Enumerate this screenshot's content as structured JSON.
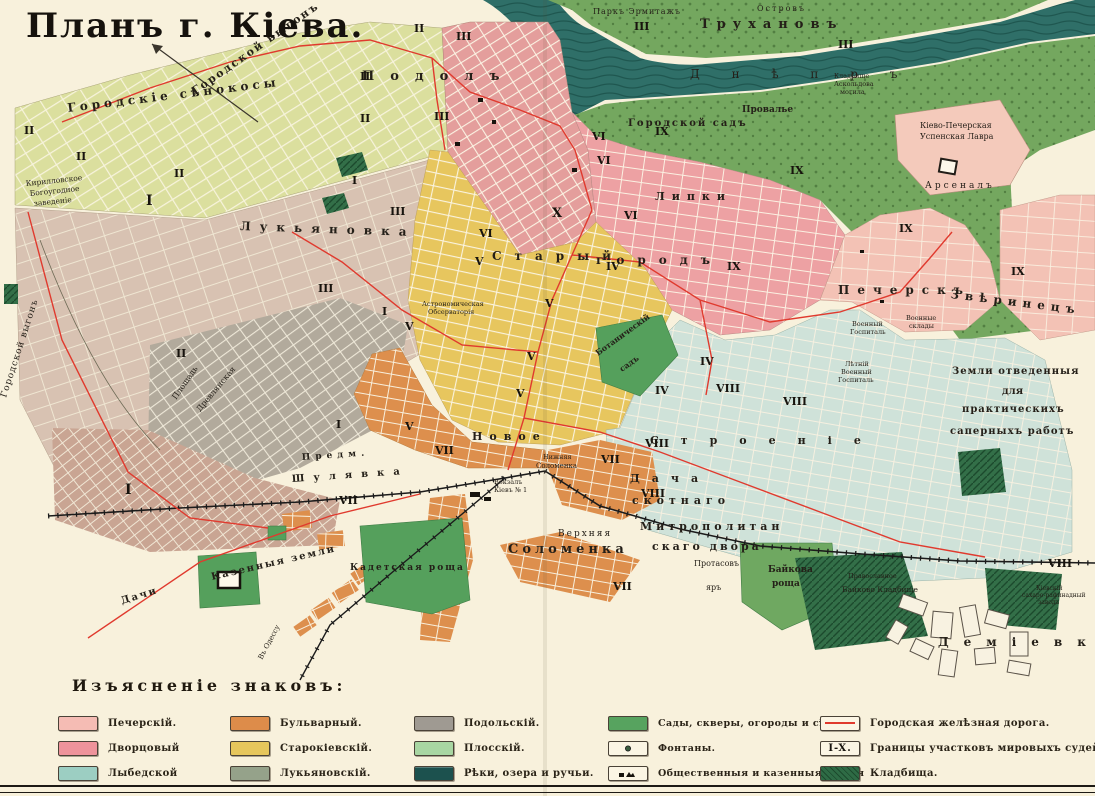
{
  "title": "Планъ г. Кіева.",
  "legend": {
    "heading": "Изъясненіе знаковъ:",
    "columns": [
      {
        "items": [
          {
            "label": "Печерскій.",
            "color": "#f5bcb4"
          },
          {
            "label": "Дворцовый",
            "color": "#ee939b"
          },
          {
            "label": "Лыбедской",
            "color": "#9ccec2"
          }
        ]
      },
      {
        "items": [
          {
            "label": "Бульварный.",
            "color": "#dd8c4a"
          },
          {
            "label": "Старокіевскій.",
            "color": "#e6c65c"
          },
          {
            "label": "Лукьяновскій.",
            "color": "#95a28a"
          }
        ]
      },
      {
        "items": [
          {
            "label": "Подольскій.",
            "color": "#9f9a92"
          },
          {
            "label": "Плосскій.",
            "color": "#a8d6a2"
          },
          {
            "label": "Рѣки, озера и ручьи.",
            "color": "#1c514e"
          }
        ]
      },
      {
        "items": [
          {
            "label": "Сады, скверы, огороды и сѣнок.",
            "color": "#57a35f"
          },
          {
            "label": "Фонтаны.",
            "type": "fountain"
          },
          {
            "label": "Общественныя и казенныя зданія",
            "type": "buildings"
          }
        ]
      },
      {
        "items": [
          {
            "label": "Городская желѣзная дорога.",
            "type": "railline",
            "color": "#e03a2e"
          },
          {
            "label": "Границы участковъ мировыхъ судей.",
            "type": "districts",
            "badge": "I-X."
          },
          {
            "label": "Кладбища.",
            "type": "cemetery",
            "color": "#2e6b45"
          }
        ]
      }
    ]
  },
  "map": {
    "river_name": "Днѣпръ",
    "labels": [
      {
        "text": "Городской выгонъ",
        "x": 195,
        "y": 95,
        "size": 11,
        "rot": -35,
        "ls": 2,
        "b": 1
      },
      {
        "text": "Городскіе сѣнокосы",
        "x": 68,
        "y": 112,
        "size": 12,
        "rot": -7,
        "ls": 4,
        "b": 1
      },
      {
        "text": "Городской выгонъ",
        "x": 6,
        "y": 398,
        "size": 9,
        "rot": -72,
        "ls": 1
      },
      {
        "text": "Кирилловское",
        "x": 26,
        "y": 186,
        "size": 7.5,
        "rot": -6
      },
      {
        "text": "Богоугодное",
        "x": 30,
        "y": 196,
        "size": 7.5,
        "rot": -6
      },
      {
        "text": "заведеніе",
        "x": 34,
        "y": 206,
        "size": 7.5,
        "rot": -6
      },
      {
        "text": "Паркъ Эрмитажъ",
        "x": 593,
        "y": 14,
        "size": 8,
        "ls": 1
      },
      {
        "text": "Островъ",
        "x": 757,
        "y": 11,
        "size": 8,
        "ls": 2
      },
      {
        "text": "Трухановъ",
        "x": 700,
        "y": 28,
        "size": 13,
        "ls": 7,
        "b": 1
      },
      {
        "text": "Д н ѣ п р ъ",
        "x": 690,
        "y": 78,
        "size": 12,
        "ls": 14,
        "c": "#143e3b"
      },
      {
        "text": "Подолъ",
        "x": 362,
        "y": 80,
        "size": 13,
        "ls": 16,
        "b": 1
      },
      {
        "text": "Провалье",
        "x": 742,
        "y": 112,
        "size": 9,
        "b": 1
      },
      {
        "text": "Городской садъ",
        "x": 628,
        "y": 126,
        "size": 10,
        "ls": 2,
        "b": 1
      },
      {
        "text": "Кладбище",
        "x": 834,
        "y": 78,
        "size": 6.5
      },
      {
        "text": "Аскольдова",
        "x": 834,
        "y": 86,
        "size": 6.5
      },
      {
        "text": "могила",
        "x": 840,
        "y": 94,
        "size": 6.5
      },
      {
        "text": "Кіево-Печерская",
        "x": 920,
        "y": 128,
        "size": 8
      },
      {
        "text": "Успенская Лавра",
        "x": 920,
        "y": 139,
        "size": 8
      },
      {
        "text": "Арсеналъ",
        "x": 925,
        "y": 188,
        "size": 9,
        "ls": 3
      },
      {
        "text": "Липки",
        "x": 655,
        "y": 200,
        "size": 11,
        "ls": 7,
        "b": 1
      },
      {
        "text": "Лукьяновка",
        "x": 240,
        "y": 230,
        "size": 12,
        "ls": 9,
        "rot": 2,
        "b": 1
      },
      {
        "text": "Старый",
        "x": 492,
        "y": 260,
        "size": 12,
        "ls": 13,
        "b": 1
      },
      {
        "text": "городъ",
        "x": 596,
        "y": 264,
        "size": 12,
        "ls": 13,
        "b": 1
      },
      {
        "text": "Печерскъ",
        "x": 838,
        "y": 294,
        "size": 12,
        "ls": 8,
        "b": 1
      },
      {
        "text": "Звѣринецъ",
        "x": 950,
        "y": 298,
        "size": 12,
        "ls": 6,
        "rot": 7,
        "b": 1
      },
      {
        "text": "Астрономическая",
        "x": 422,
        "y": 306,
        "size": 6.5
      },
      {
        "text": "Обсерваторія",
        "x": 428,
        "y": 314,
        "size": 6.5
      },
      {
        "text": "Ботаническій",
        "x": 598,
        "y": 356,
        "size": 8,
        "rot": -36,
        "b": 1
      },
      {
        "text": "садъ",
        "x": 622,
        "y": 372,
        "size": 8,
        "rot": -36,
        "b": 1
      },
      {
        "text": "Военный",
        "x": 852,
        "y": 326,
        "size": 6.5
      },
      {
        "text": "Госпиталь",
        "x": 850,
        "y": 334,
        "size": 6.5
      },
      {
        "text": "Военные",
        "x": 906,
        "y": 320,
        "size": 6.5
      },
      {
        "text": "склады",
        "x": 909,
        "y": 328,
        "size": 6.5
      },
      {
        "text": "Лѣтній",
        "x": 845,
        "y": 366,
        "size": 6.5
      },
      {
        "text": "Военный",
        "x": 841,
        "y": 374,
        "size": 6.5
      },
      {
        "text": "Госпиталь",
        "x": 838,
        "y": 382,
        "size": 6.5
      },
      {
        "text": "Земли отведенныя",
        "x": 952,
        "y": 374,
        "size": 10,
        "ls": 1,
        "b": 1
      },
      {
        "text": "для",
        "x": 1002,
        "y": 394,
        "size": 10,
        "b": 1
      },
      {
        "text": "практическихъ",
        "x": 962,
        "y": 412,
        "size": 10,
        "ls": 1,
        "b": 1
      },
      {
        "text": "саперныхъ работъ",
        "x": 950,
        "y": 434,
        "size": 10,
        "ls": 1,
        "b": 1
      },
      {
        "text": "Площадь",
        "x": 176,
        "y": 400,
        "size": 8,
        "rot": -55
      },
      {
        "text": "Древлянская",
        "x": 200,
        "y": 412,
        "size": 8,
        "rot": -50
      },
      {
        "text": "Предм.",
        "x": 302,
        "y": 460,
        "size": 9,
        "ls": 5,
        "rot": -4,
        "b": 1
      },
      {
        "text": "Шулявка",
        "x": 292,
        "y": 482,
        "size": 10,
        "ls": 9,
        "rot": -4,
        "b": 1
      },
      {
        "text": "Новое",
        "x": 472,
        "y": 440,
        "size": 11,
        "ls": 7,
        "b": 1
      },
      {
        "text": "Строеніе",
        "x": 650,
        "y": 444,
        "size": 11,
        "ls": 22,
        "b": 1
      },
      {
        "text": "Нижняя",
        "x": 543,
        "y": 459,
        "size": 6.5
      },
      {
        "text": "Соломенка",
        "x": 536,
        "y": 468,
        "size": 7
      },
      {
        "text": "Вокзалъ",
        "x": 494,
        "y": 484,
        "size": 6.5
      },
      {
        "text": "Кіевъ № 1",
        "x": 494,
        "y": 492,
        "size": 6.5
      },
      {
        "text": "Верхняя",
        "x": 558,
        "y": 536,
        "size": 9,
        "ls": 2
      },
      {
        "text": "Соломенка",
        "x": 508,
        "y": 553,
        "size": 13,
        "ls": 4,
        "b": 1
      },
      {
        "text": "Дача",
        "x": 630,
        "y": 482,
        "size": 11,
        "ls": 12,
        "b": 1
      },
      {
        "text": "скотнаго",
        "x": 632,
        "y": 504,
        "size": 11,
        "ls": 5,
        "b": 1
      },
      {
        "text": "Митрополитан",
        "x": 640,
        "y": 530,
        "size": 11,
        "ls": 4,
        "b": 1
      },
      {
        "text": "скаго двора",
        "x": 652,
        "y": 550,
        "size": 11,
        "ls": 3,
        "b": 1
      },
      {
        "text": "Кадетская роща",
        "x": 350,
        "y": 570,
        "size": 9,
        "ls": 2,
        "b": 1
      },
      {
        "text": "Казенныя земли",
        "x": 212,
        "y": 580,
        "size": 10,
        "ls": 2,
        "rot": -13,
        "b": 1
      },
      {
        "text": "Дачи",
        "x": 122,
        "y": 604,
        "size": 10,
        "ls": 2,
        "rot": -17,
        "b": 1
      },
      {
        "text": "Протасовъ",
        "x": 694,
        "y": 566,
        "size": 8
      },
      {
        "text": "яръ",
        "x": 706,
        "y": 590,
        "size": 8
      },
      {
        "text": "Байкова",
        "x": 768,
        "y": 572,
        "size": 9,
        "b": 1
      },
      {
        "text": "роща",
        "x": 772,
        "y": 586,
        "size": 9,
        "b": 1
      },
      {
        "text": "Православное",
        "x": 848,
        "y": 578,
        "size": 6.5,
        "c": "#2c4c35"
      },
      {
        "text": "Байково Кладбище",
        "x": 842,
        "y": 592,
        "size": 7.5,
        "c": "#2c4c35"
      },
      {
        "text": "Деміевка",
        "x": 938,
        "y": 646,
        "size": 12,
        "ls": 15,
        "b": 1
      },
      {
        "text": "Кіевскій",
        "x": 1036,
        "y": 590,
        "size": 6
      },
      {
        "text": "сахаро-рафинадный",
        "x": 1022,
        "y": 597,
        "size": 6
      },
      {
        "text": "заводъ",
        "x": 1038,
        "y": 604,
        "size": 6
      },
      {
        "text": "Въ Одессу",
        "x": 262,
        "y": 660,
        "size": 7,
        "rot": -62
      }
    ],
    "numerals": [
      {
        "t": "II",
        "x": 24,
        "y": 134
      },
      {
        "t": "I",
        "x": 146,
        "y": 205,
        "size": 14
      },
      {
        "t": "II",
        "x": 76,
        "y": 160
      },
      {
        "t": "II",
        "x": 174,
        "y": 177
      },
      {
        "t": "II",
        "x": 414,
        "y": 32
      },
      {
        "t": "II",
        "x": 360,
        "y": 80
      },
      {
        "t": "II",
        "x": 360,
        "y": 122
      },
      {
        "t": "II",
        "x": 176,
        "y": 357
      },
      {
        "t": "III",
        "x": 456,
        "y": 40
      },
      {
        "t": "III",
        "x": 434,
        "y": 120
      },
      {
        "t": "III",
        "x": 390,
        "y": 215
      },
      {
        "t": "III",
        "x": 318,
        "y": 292
      },
      {
        "t": "III",
        "x": 634,
        "y": 30
      },
      {
        "t": "III",
        "x": 838,
        "y": 48
      },
      {
        "t": "I",
        "x": 352,
        "y": 184
      },
      {
        "t": "I",
        "x": 382,
        "y": 315
      },
      {
        "t": "I",
        "x": 125,
        "y": 494,
        "size": 14
      },
      {
        "t": "I",
        "x": 336,
        "y": 428
      },
      {
        "t": "IV",
        "x": 606,
        "y": 270
      },
      {
        "t": "IV",
        "x": 700,
        "y": 365
      },
      {
        "t": "IV",
        "x": 655,
        "y": 394
      },
      {
        "t": "V",
        "x": 475,
        "y": 265
      },
      {
        "t": "V",
        "x": 545,
        "y": 307
      },
      {
        "t": "V",
        "x": 527,
        "y": 360
      },
      {
        "t": "V",
        "x": 405,
        "y": 330
      },
      {
        "t": "V",
        "x": 405,
        "y": 430
      },
      {
        "t": "V",
        "x": 516,
        "y": 397
      },
      {
        "t": "VI",
        "x": 592,
        "y": 140
      },
      {
        "t": "VI",
        "x": 597,
        "y": 164
      },
      {
        "t": "VI",
        "x": 624,
        "y": 219
      },
      {
        "t": "VI",
        "x": 479,
        "y": 237
      },
      {
        "t": "VII",
        "x": 339,
        "y": 504
      },
      {
        "t": "VII",
        "x": 435,
        "y": 454
      },
      {
        "t": "VII",
        "x": 601,
        "y": 463
      },
      {
        "t": "VII",
        "x": 613,
        "y": 590
      },
      {
        "t": "VIII",
        "x": 716,
        "y": 392
      },
      {
        "t": "VIII",
        "x": 783,
        "y": 405
      },
      {
        "t": "VIII",
        "x": 645,
        "y": 447
      },
      {
        "t": "VIII",
        "x": 641,
        "y": 497
      },
      {
        "t": "VIII",
        "x": 1048,
        "y": 567
      },
      {
        "t": "IX",
        "x": 655,
        "y": 135
      },
      {
        "t": "IX",
        "x": 790,
        "y": 174
      },
      {
        "t": "IX",
        "x": 899,
        "y": 232
      },
      {
        "t": "IX",
        "x": 1011,
        "y": 275
      },
      {
        "t": "IX",
        "x": 727,
        "y": 270
      },
      {
        "t": "X",
        "x": 552,
        "y": 217,
        "size": 13
      }
    ]
  }
}
